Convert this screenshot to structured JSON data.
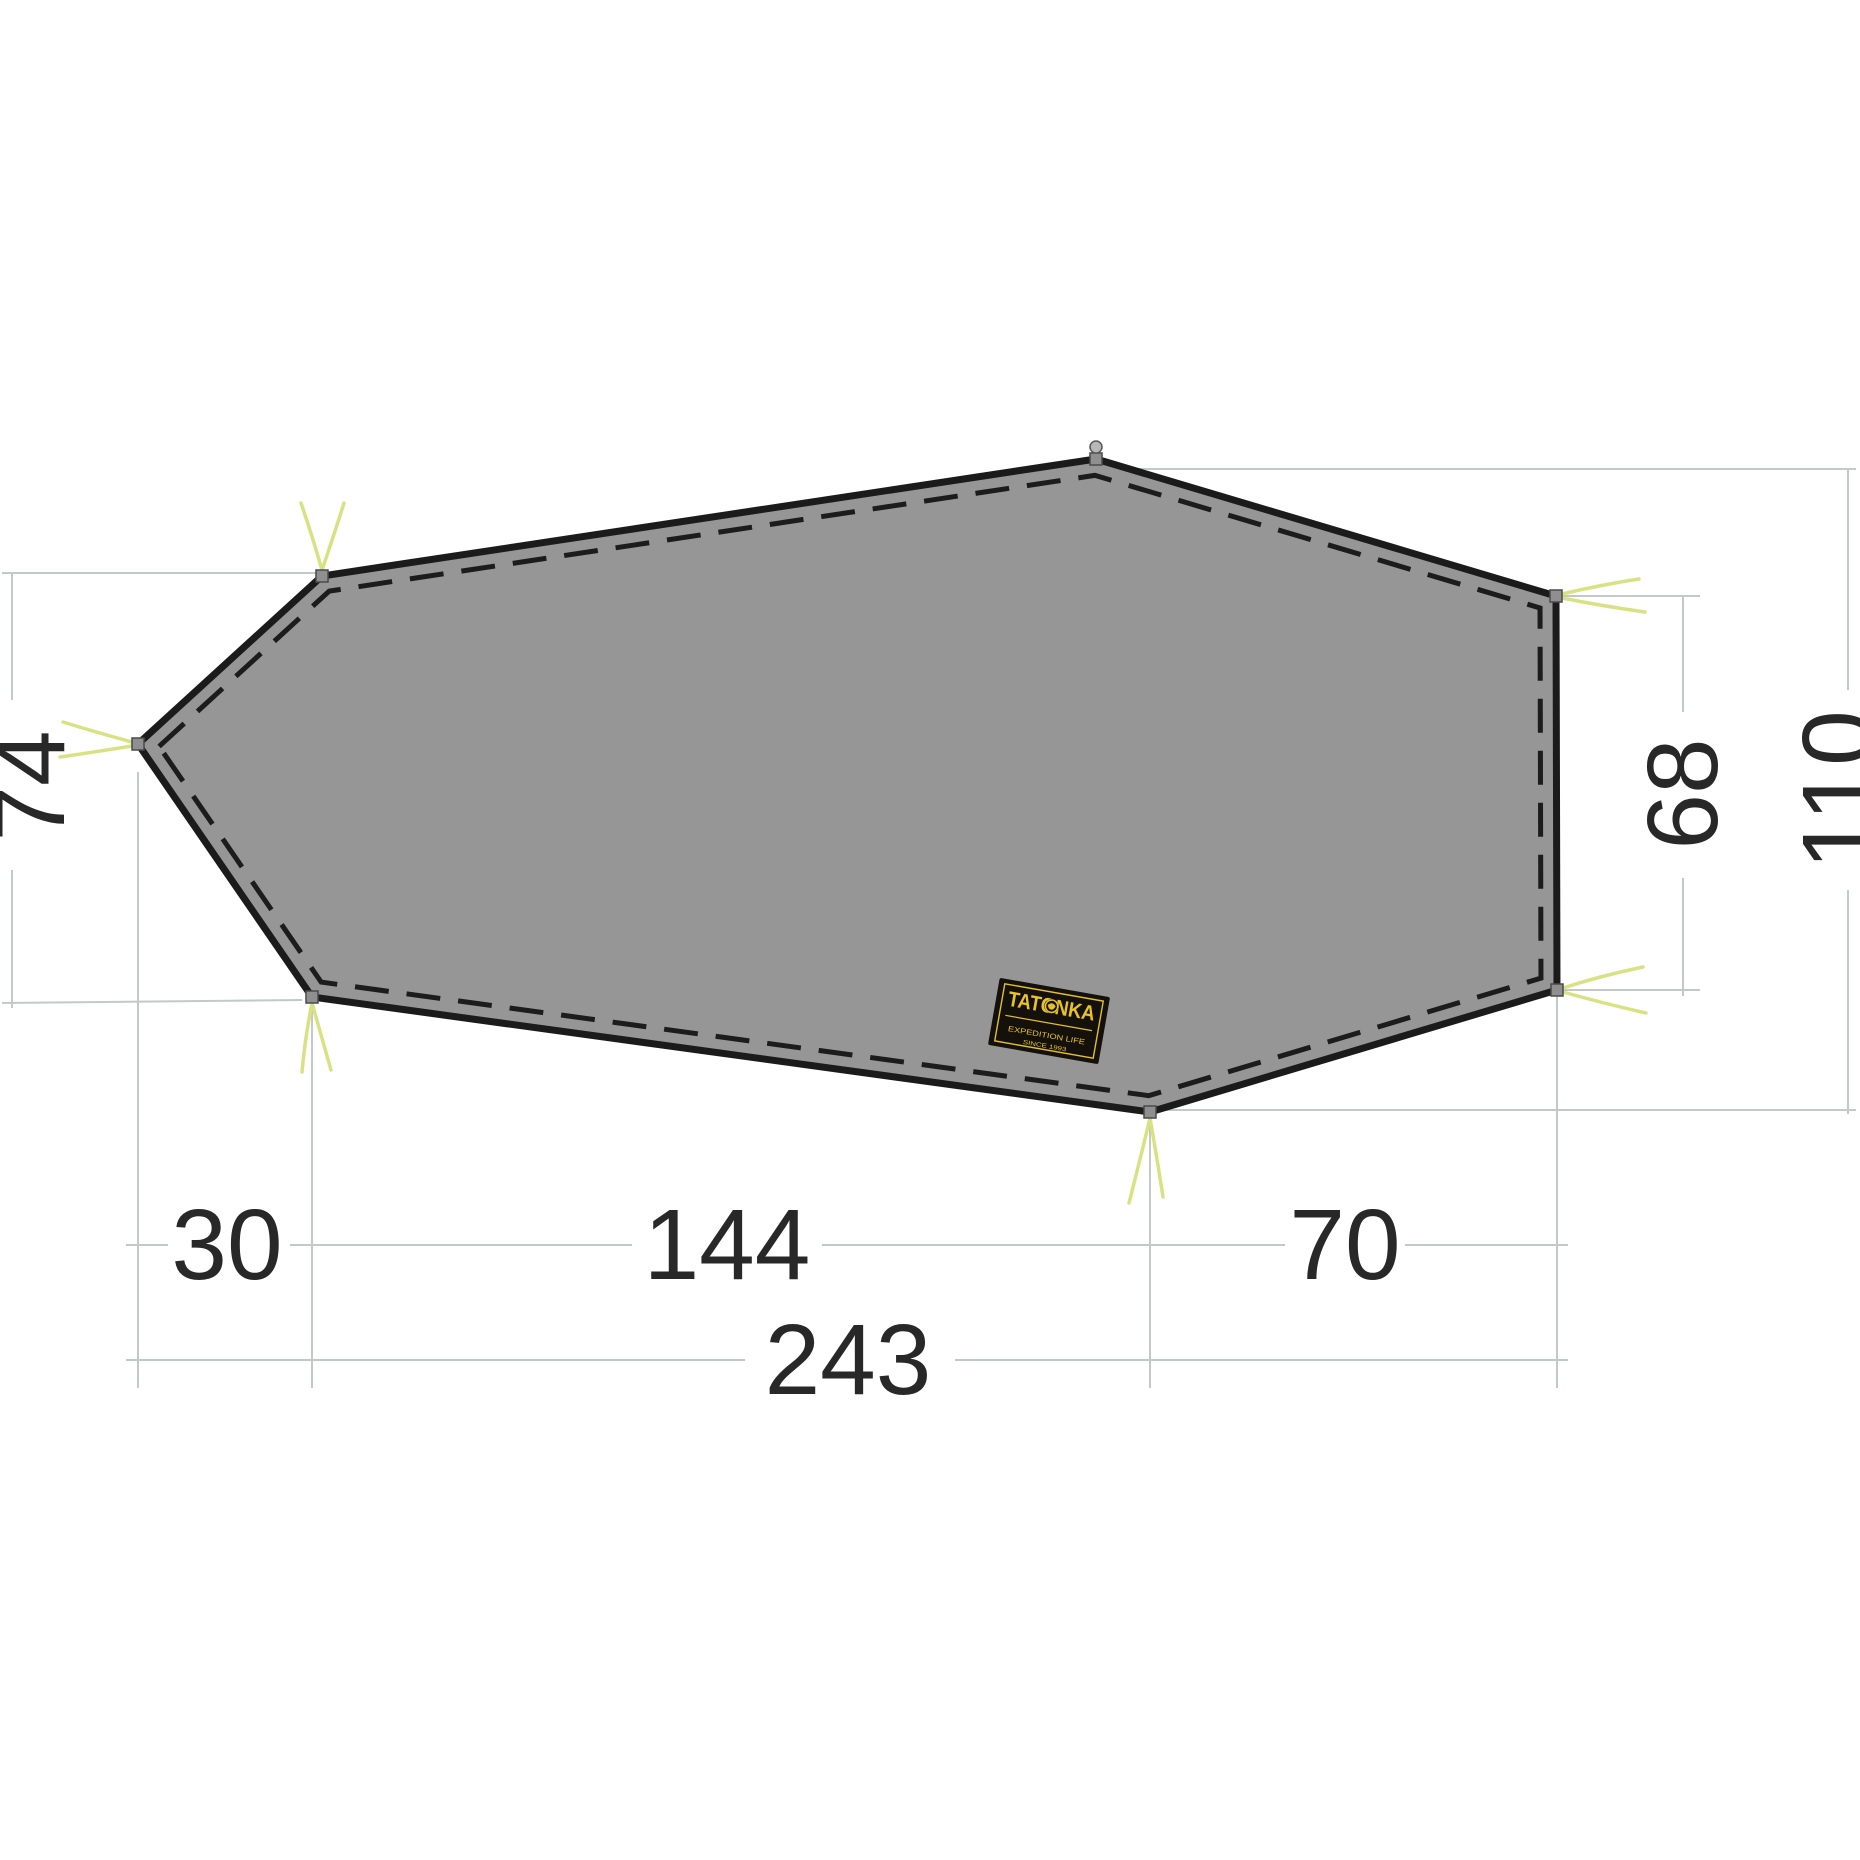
{
  "diagram": {
    "background": "#ffffff",
    "shape": {
      "name": "tent-footprint",
      "fill": "#969696",
      "stroke": "#1b1b1b",
      "stroke_width": 7,
      "seam_color": "#1c1c1c",
      "seam_width": 5,
      "seam_dash": "34 18",
      "seam_inset": 16,
      "vertices": [
        [
          138,
          744
        ],
        [
          322,
          576
        ],
        [
          1096,
          459
        ],
        [
          1556,
          596
        ],
        [
          1557,
          990
        ],
        [
          1150,
          1112
        ],
        [
          312,
          997
        ]
      ]
    },
    "eyelet": {
      "color": "#8f8f8f",
      "border": "#4a4a4a",
      "size": 12
    },
    "stake": {
      "x": 1096,
      "y": 447,
      "fill": "#b8b8b8",
      "border": "#5a5a5a"
    },
    "guy_lines": {
      "color": "#d9e283",
      "width": 3.5,
      "strands": [
        [
          132,
          742,
          95,
          732,
          63,
          722
        ],
        [
          132,
          746,
          95,
          752,
          60,
          757
        ],
        [
          322,
          570,
          312,
          535,
          301,
          503
        ],
        [
          322,
          570,
          334,
          535,
          344,
          503
        ],
        [
          1562,
          594,
          1600,
          585,
          1639,
          579
        ],
        [
          1562,
          598,
          1602,
          606,
          1645,
          612
        ],
        [
          1563,
          988,
          1600,
          976,
          1643,
          967
        ],
        [
          1563,
          992,
          1602,
          1003,
          1646,
          1013
        ],
        [
          1150,
          1118,
          1140,
          1160,
          1129,
          1203
        ],
        [
          1150,
          1118,
          1157,
          1158,
          1163,
          1197
        ],
        [
          312,
          1003,
          305,
          1038,
          302,
          1072
        ],
        [
          312,
          1003,
          322,
          1038,
          331,
          1070
        ]
      ]
    },
    "dim_style": {
      "line_color": "#c3c8c8",
      "line_width": 2,
      "text_color": "#282828",
      "font_size": 100
    },
    "extension_lines": [
      [
        2,
        573,
        322,
        573
      ],
      [
        2,
        1003,
        302,
        1000
      ],
      [
        1100,
        469,
        1856,
        469
      ],
      [
        1562,
        596,
        1700,
        596
      ],
      [
        1563,
        990,
        1700,
        990
      ],
      [
        1162,
        1110,
        1856,
        1110
      ],
      [
        138,
        772,
        138,
        1388
      ],
      [
        312,
        1004,
        312,
        1388
      ],
      [
        1150,
        1126,
        1150,
        1388
      ],
      [
        1557,
        994,
        1557,
        1388
      ]
    ],
    "dimension_segments": [
      [
        12,
        573,
        12,
        700
      ],
      [
        12,
        870,
        12,
        1008
      ],
      [
        1683,
        596,
        1683,
        712
      ],
      [
        1683,
        878,
        1683,
        996
      ],
      [
        1848,
        469,
        1848,
        690
      ],
      [
        1848,
        890,
        1848,
        1114
      ],
      [
        126,
        1245,
        168,
        1245
      ],
      [
        290,
        1245,
        632,
        1245
      ],
      [
        822,
        1245,
        1285,
        1245
      ],
      [
        1405,
        1245,
        1568,
        1245
      ],
      [
        126,
        1360,
        745,
        1360
      ],
      [
        955,
        1360,
        1568,
        1360
      ]
    ],
    "labels": [
      {
        "name": "dim-74",
        "text": "74",
        "x": 30,
        "y": 786,
        "rotate": -90
      },
      {
        "name": "dim-68",
        "text": "68",
        "x": 1683,
        "y": 794,
        "rotate": -90
      },
      {
        "name": "dim-110",
        "text": "110",
        "x": 1838,
        "y": 790,
        "rotate": -90
      },
      {
        "name": "dim-30",
        "text": "30",
        "x": 227,
        "y": 1245,
        "rotate": 0
      },
      {
        "name": "dim-144",
        "text": "144",
        "x": 727,
        "y": 1245,
        "rotate": 0
      },
      {
        "name": "dim-70",
        "text": "70",
        "x": 1345,
        "y": 1245,
        "rotate": 0
      },
      {
        "name": "dim-243",
        "text": "243",
        "x": 848,
        "y": 1360,
        "rotate": 0
      }
    ],
    "brand_label": {
      "cx": 1049,
      "cy": 1021,
      "w": 112,
      "h": 68,
      "rotate": 10,
      "bg": "#14110c",
      "frame_color": "#e3bf2b",
      "text_color": "#e8c227",
      "title": "TATONKA",
      "subtitle": "EXPEDITION LIFE",
      "since": "SINCE 1993"
    }
  }
}
